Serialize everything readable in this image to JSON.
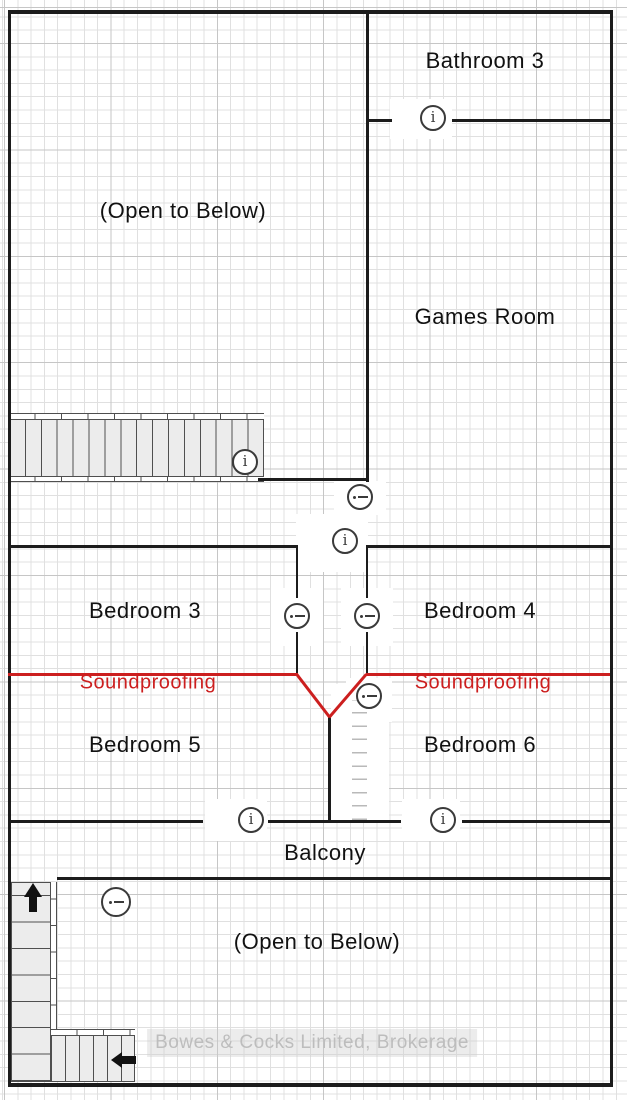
{
  "floor_plan": {
    "rooms": {
      "bathroom3": "Bathroom 3",
      "open_below_top": "(Open to Below)",
      "games_room": "Games Room",
      "bedroom3": "Bedroom 3",
      "bedroom4": "Bedroom 4",
      "bedroom5": "Bedroom 5",
      "bedroom6": "Bedroom 6",
      "balcony": "Balcony",
      "open_below_bottom": "(Open to Below)"
    },
    "annotations": {
      "soundproofing_left": "Soundproofing",
      "soundproofing_right": "Soundproofing"
    },
    "watermark": "Bowes & Cocks Limited, Brokerage",
    "glyphs": {
      "info": "i"
    },
    "icons": [
      {
        "name": "info-icon-bathroom-door"
      },
      {
        "name": "info-icon-upper-stairs"
      },
      {
        "name": "collapse-icon-hall-top"
      },
      {
        "name": "info-icon-hall-door"
      },
      {
        "name": "collapse-icon-bedroom3-door"
      },
      {
        "name": "collapse-icon-bedroom4-door"
      },
      {
        "name": "collapse-icon-bedroom6-closet"
      },
      {
        "name": "info-icon-balcony-door-left"
      },
      {
        "name": "info-icon-balcony-door-right"
      },
      {
        "name": "collapse-icon-lower-stairs"
      },
      {
        "name": "up-arrow-icon"
      },
      {
        "name": "left-arrow-icon"
      }
    ],
    "colors": {
      "wall": "#1c1c1c",
      "soundproofing_line": "#cc1f1f",
      "grid_minor": "#e0e0e0",
      "grid_major": "#c6c6c6",
      "stair_fill": "#ececec",
      "icon_stroke": "#3a3a3a",
      "watermark_text": "#bdbdbd"
    }
  }
}
